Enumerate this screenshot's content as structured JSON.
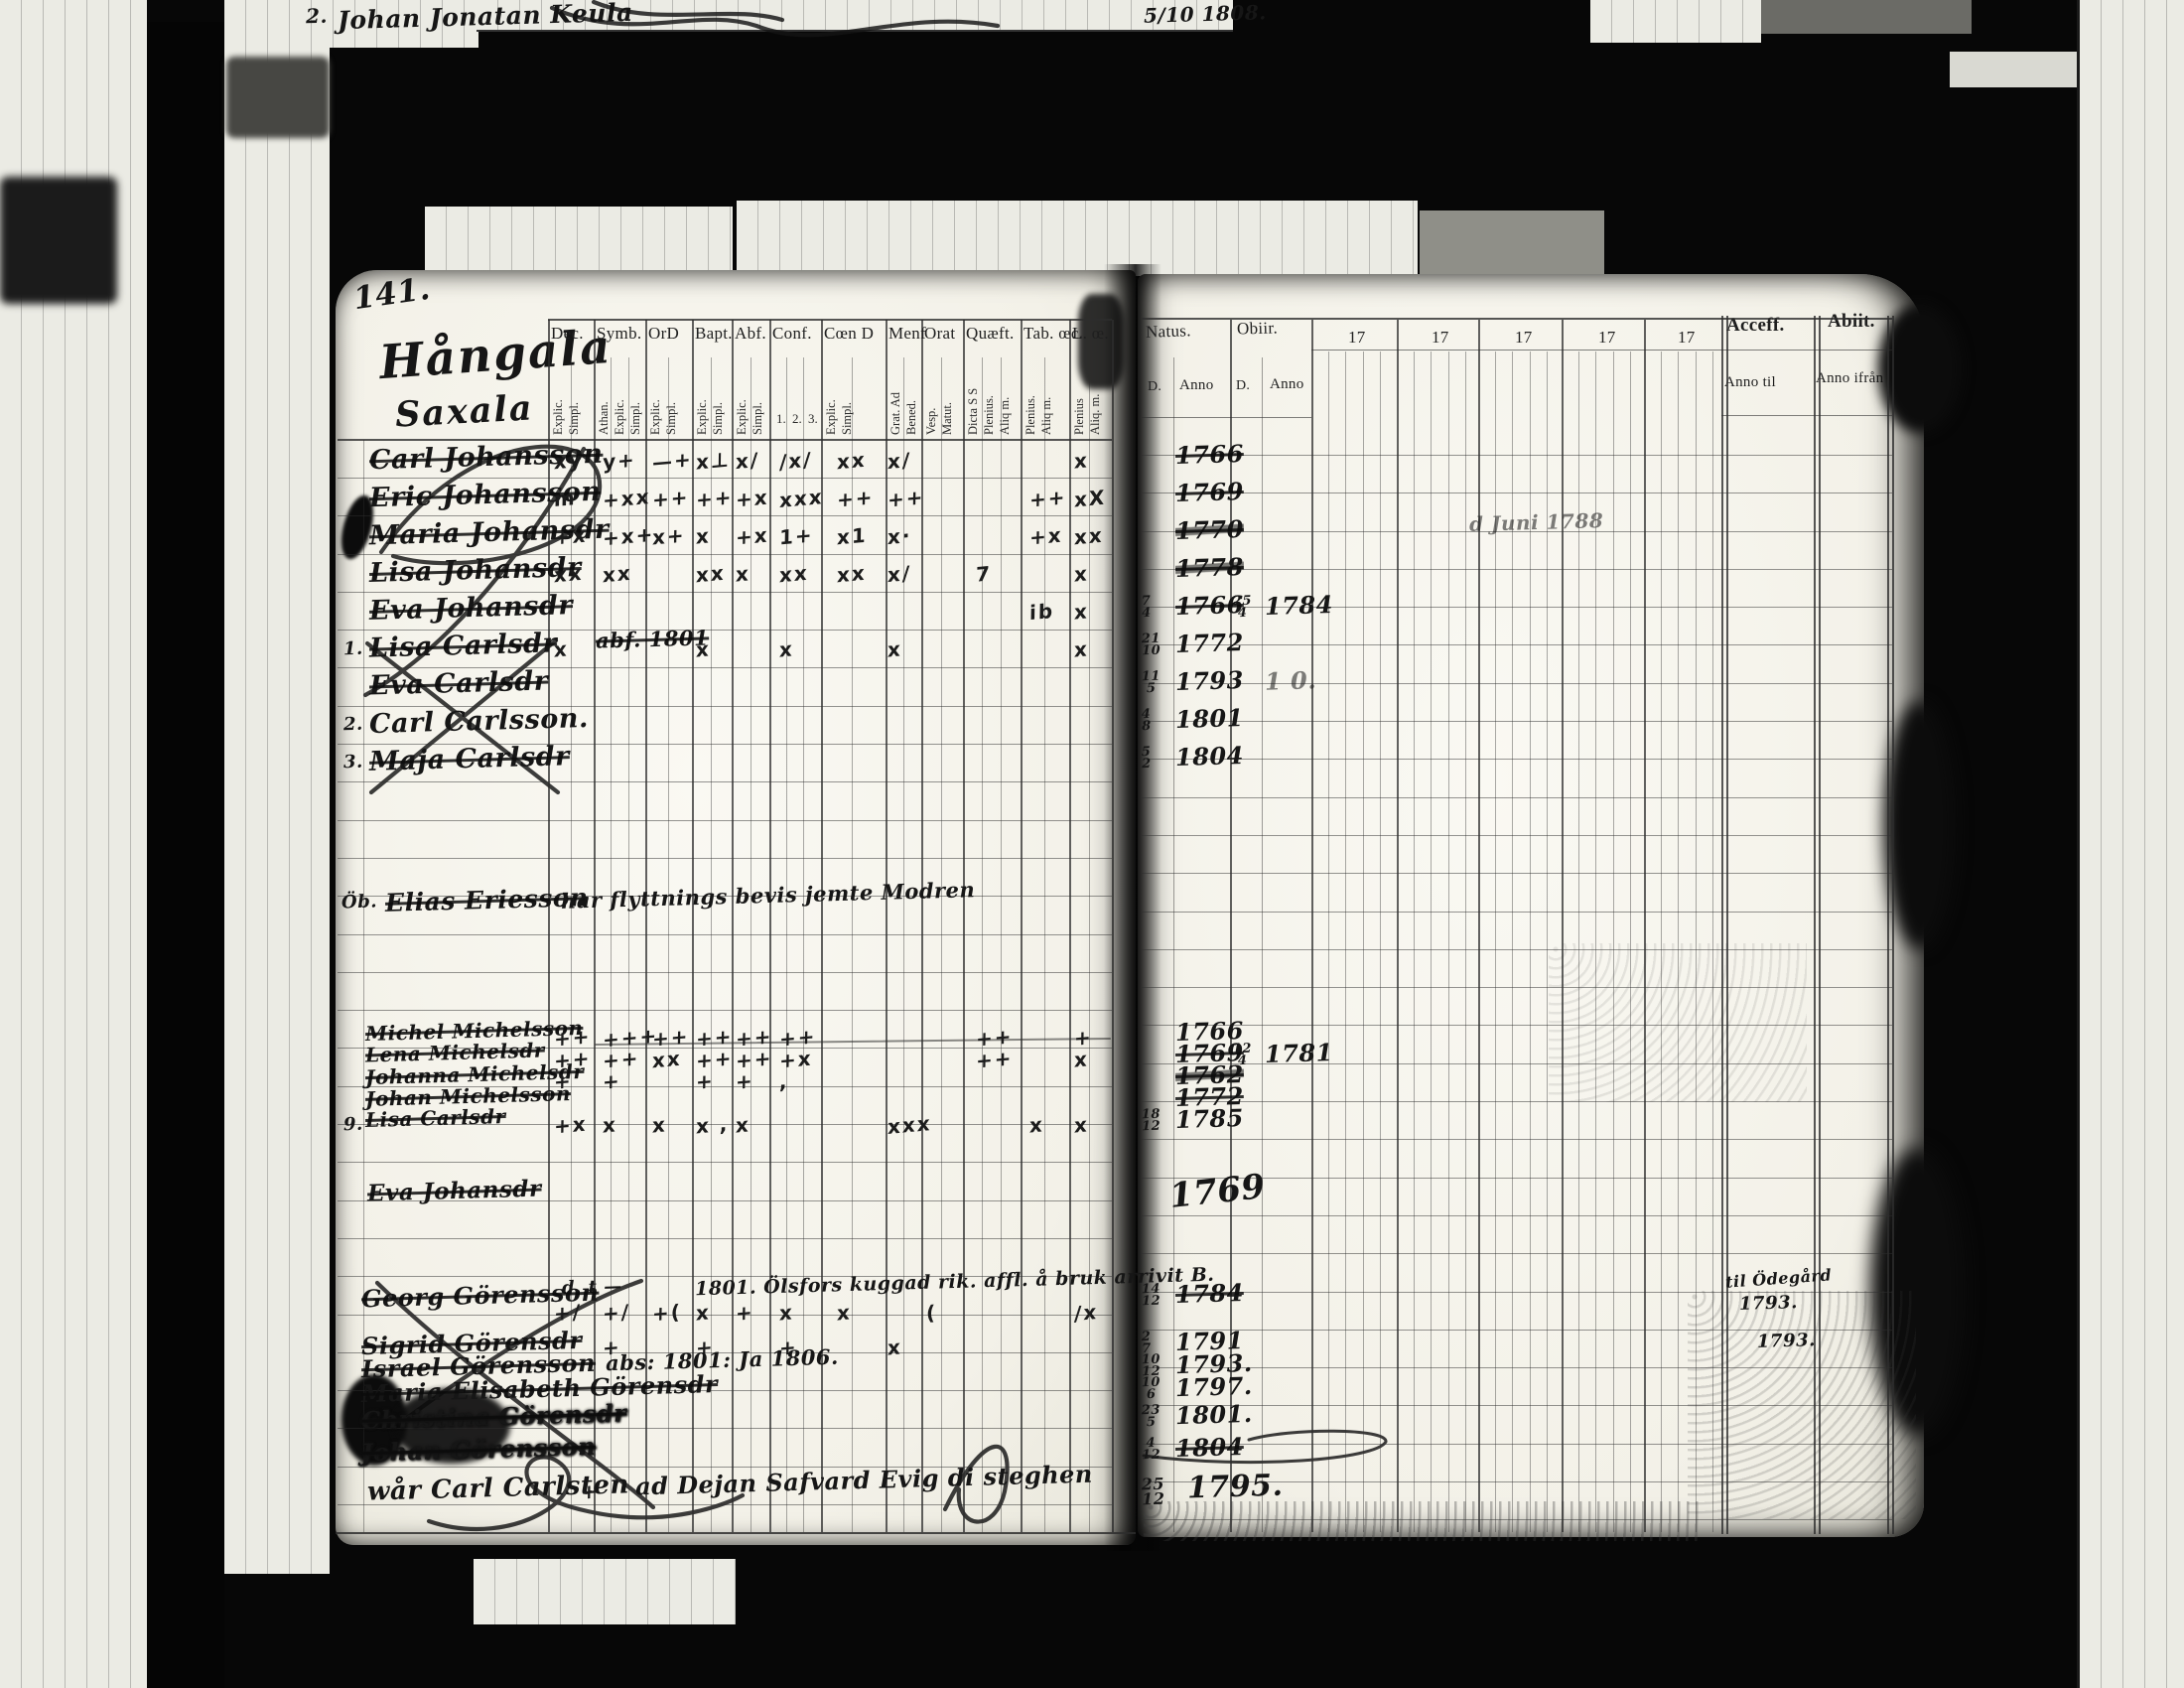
{
  "film": {
    "top_mark": "2.",
    "top_name": "Johan Jonatan Keula",
    "top_date": "5/10 1808."
  },
  "left_page": {
    "page_number": "141.",
    "heading": {
      "line1": "Hångala",
      "line2": "Saxala"
    },
    "columns": [
      {
        "label": "Dec.",
        "subs": [
          "Explic.",
          "Simpl."
        ]
      },
      {
        "label": "Symb.",
        "subs": [
          "Athan.",
          "Explic.",
          "Simpl."
        ]
      },
      {
        "label": "OrD",
        "subs": [
          "Explic.",
          "Simpl."
        ]
      },
      {
        "label": "Bapt.",
        "subs": [
          "Explic.",
          "Simpl."
        ]
      },
      {
        "label": "Abf.",
        "subs": [
          "Explic.",
          "Simpl."
        ]
      },
      {
        "label": "Conf.",
        "subs": [
          "1.",
          "2.",
          "3."
        ],
        "horizontal_subs": true
      },
      {
        "label": "Cœn D",
        "subs": [
          "Explic.",
          "Simpl."
        ]
      },
      {
        "label": "Menf",
        "subs": [
          "Grat. Ad",
          "Bened."
        ]
      },
      {
        "label": "Orat",
        "subs": [
          "Vesp.",
          "Matut."
        ]
      },
      {
        "label": "Quæft.",
        "subs": [
          "Dicta S S",
          "Plenius.",
          "Aliq m."
        ]
      },
      {
        "label": "Tab. œc.",
        "subs": [
          "Plenius.",
          "Aliq m."
        ]
      },
      {
        "label": "L. œ.",
        "subs": [
          "Plenius",
          "Aliq. m."
        ]
      }
    ]
  },
  "right_page": {
    "headers": {
      "natus": "Natus.",
      "natus_sub_d": "D.",
      "natus_sub_anno": "Anno",
      "obiit": "Obiir.",
      "obiit_sub_d": "D.",
      "obiit_sub_anno": "Anno",
      "decades": [
        "17",
        "17",
        "17",
        "17",
        "17"
      ],
      "accessit": "Acceff.",
      "accessit_sub": "Anno til",
      "abiit": "Abiit.",
      "abiit_sub": "Anno ifrån"
    }
  },
  "blocks": {
    "block1": {
      "rows": [
        {
          "name": "Carl Johansson",
          "struck": 1,
          "marks": {
            "0": "xy",
            "1": "y+",
            "2": "—+",
            "3": "x⊥",
            "4": "x/",
            "5": "/x/",
            "6": "xx",
            "7": "x/",
            "11": "x"
          },
          "natus_anno": "1766",
          "natus_struck": 1
        },
        {
          "name": "Eric Johansson",
          "struck": 1,
          "marks": {
            "0": "m",
            "1": "+xx",
            "2": "++",
            "3": "++",
            "4": "+x",
            "5": "xxx",
            "6": "++",
            "7": "++",
            "10": "++",
            "11": "xX"
          },
          "natus_anno": "1769",
          "natus_struck": 1
        },
        {
          "name": "Maria Johansdr",
          "struck": 1,
          "marks": {
            "0": "+x",
            "1": "+x+",
            "2": "x+",
            "3": "x",
            "4": "+x",
            "5": "1+",
            "6": "x1",
            "7": "x·",
            "10": "+x",
            "11": "xx"
          },
          "natus_anno": "1770",
          "natus_struck": 1,
          "natus_scrib": 1,
          "annotation": "d Juni 1788"
        },
        {
          "name": "Lisa Johansdr",
          "struck": 1,
          "marks": {
            "0": "xx",
            "1": "xx",
            "3": "xx",
            "4": "x",
            "5": "xx",
            "6": "xx",
            "7": "x/",
            "9": "7",
            "11": "x"
          },
          "natus_anno": "1778",
          "natus_struck": 1,
          "natus_scrib": 1
        },
        {
          "name": "Eva Johansdr",
          "struck": 1,
          "marks": {
            "10": "ib",
            "11": "x"
          },
          "natus_d": "7/4",
          "natus_anno": "1766",
          "natus_struck": 1,
          "obiit_d": "25/4",
          "obiit_anno": "1784"
        },
        {
          "num": "1.",
          "name": "Lisa Carlsdr",
          "struck": 1,
          "note": "abf. 1801",
          "marks": {
            "0": "x",
            "3": "x",
            "5": "x",
            "7": "x",
            "11": "x"
          },
          "natus_d": "21/10",
          "natus_anno": "1772"
        },
        {
          "name": "Eva Carlsdr",
          "struck": 1,
          "natus_d": "11/5",
          "natus_anno": "1793",
          "obiit_anno": "1 0.",
          "obiit_faint": 1
        },
        {
          "num": "2.",
          "name": "Carl Carlsson.",
          "natus_d": "4/8",
          "natus_anno": "1801"
        },
        {
          "num": "3.",
          "name": "Maja Carlsdr",
          "struck": 1,
          "natus_d": "5/2",
          "natus_anno": "1804"
        }
      ]
    },
    "note_row": {
      "prefix": "Öb.",
      "name": "Elias Eriesson",
      "note": "har flyttnings bevis jemte Modren"
    },
    "block2": {
      "rows": [
        {
          "name": "Michel Michelsson",
          "struck": 1,
          "marks": {
            "0": "++",
            "1": "+++",
            "2": "++",
            "3": "++",
            "4": "++",
            "5": "++",
            "9": "++",
            "11": "+"
          },
          "natus_anno": "1766"
        },
        {
          "name": "Lena Michelsdr",
          "struck": 1,
          "marks": {
            "0": "++",
            "1": "++",
            "2": "xx",
            "3": "++",
            "4": "++",
            "5": "+x",
            "9": "++",
            "11": "x"
          },
          "natus_anno": "1769",
          "natus_struck": 1,
          "obiit_d": "12/4",
          "obiit_anno": "1781"
        },
        {
          "name": "Johanna Michelsdr",
          "struck": 1,
          "marks": {
            "0": "+",
            "1": "+",
            "3": "+",
            "4": "+",
            "5": ","
          },
          "natus_anno": "1762",
          "natus_struck": 1,
          "natus_scrib": 1
        },
        {
          "name": "Johan Michelsson",
          "struck": 1,
          "natus_anno": "1772",
          "natus_struck": 1
        },
        {
          "num": "9.",
          "name": "Lisa Carlsdr",
          "struck": 1,
          "marks": {
            "0": "+x",
            "1": "x",
            "2": "x",
            "3": "x ,",
            "4": "x",
            "7": "xxx",
            "10": "x",
            "11": "x"
          },
          "natus_d": "18/12",
          "natus_anno": "1785"
        }
      ]
    },
    "single_row": {
      "name": "Eva Johansdr",
      "struck": 1,
      "natus_anno": "1769"
    },
    "block3": {
      "pre_note_left": "d. t —",
      "pre_note": "1801. Ölsfors kuggad rik. affl. å bruk arrivit B.",
      "rows": [
        {
          "name": "Georg Görensson",
          "struck": 1,
          "marks": {
            "0": "+/",
            "1": "+/",
            "2": "+(",
            "3": "x",
            "4": "+",
            "5": "x",
            "6": "x",
            "8": "(",
            "11": "/x"
          },
          "natus_d": "14/12",
          "natus_anno": "1784",
          "natus_struck": 1
        },
        {
          "name": "Sigrid Görensdr",
          "struck": 1,
          "marks": {
            "1": "+",
            "3": "+",
            "5": "+",
            "7": "x"
          },
          "natus_d": "2/7",
          "natus_anno": "1791"
        },
        {
          "name": "Israel Görensson",
          "struck": 1,
          "note": "abs: 1801: Ja 1806.",
          "natus_d": "10/12",
          "natus_anno": "1793."
        },
        {
          "name": "Maria Elisabeth Görensdr",
          "struck": 1,
          "natus_d": "10/6",
          "natus_anno": "1797."
        },
        {
          "name": "Christina Görensdr",
          "struck": 1,
          "blot": 1,
          "natus_d": "23/5",
          "natus_anno": "1801."
        },
        {
          "name": "Johan Görensson",
          "struck": 1,
          "blot": 1,
          "natus_d": "4/12",
          "natus_anno": "1804",
          "natus_struck": 1
        }
      ],
      "accessit_note": "til Ödegård",
      "accessit_years": [
        "1793.",
        "1793."
      ]
    },
    "bottom_row": {
      "name": "wår Carl Carlsten",
      "mark": "+",
      "note": "ad Dejan Safvard Evig di steghen",
      "natus_d": "25/12",
      "natus_anno": "1795."
    }
  }
}
